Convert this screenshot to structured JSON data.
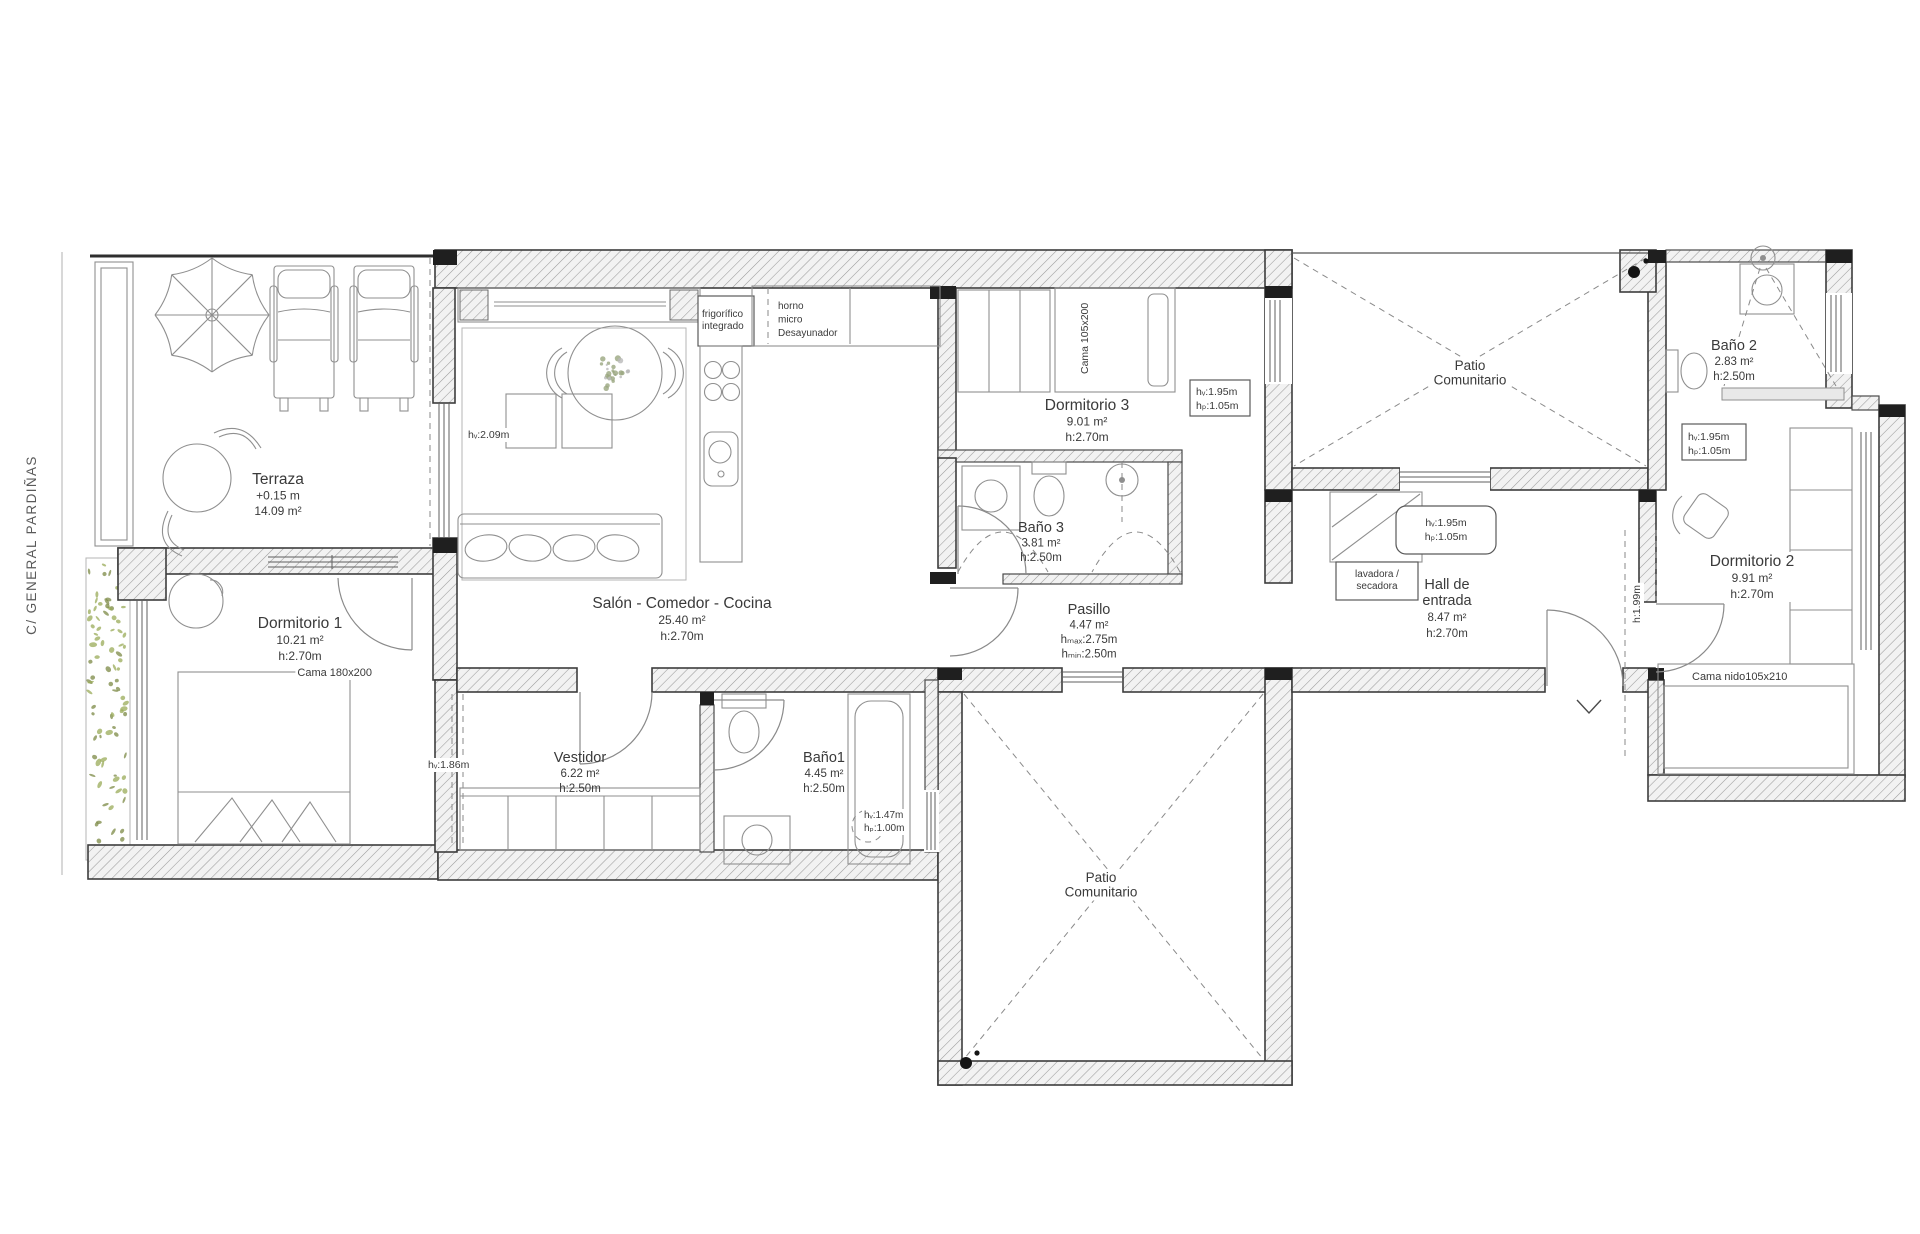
{
  "street": {
    "label": "C/ GENERAL PARDIÑAS"
  },
  "colors": {
    "text": "#3a3a3a",
    "street_text": "#5a5a5a",
    "planter_green": "#9aab58",
    "planter_green_dark": "#7c8a46",
    "flower_gray": "#9aa67f"
  },
  "rooms": {
    "terraza": {
      "name": "Terraza",
      "elevation": "+0.15 m",
      "area": "14.09 m²"
    },
    "dormitorio1": {
      "name": "Dormitorio 1",
      "area": "10.21 m²",
      "height": "h:2.70m",
      "bed": "Cama 180x200"
    },
    "salon": {
      "name": "Salón - Comedor - Cocina",
      "area": "25.40 m²",
      "height": "h:2.70m"
    },
    "dormitorio3": {
      "name": "Dormitorio 3",
      "area": "9.01 m²",
      "height": "h:2.70m",
      "bed": "Cama 105x200"
    },
    "bano3": {
      "name": "Baño 3",
      "area": "3.81 m²",
      "height": "h:2.50m"
    },
    "pasillo": {
      "name": "Pasillo",
      "area": "4.47 m²",
      "height_max": "hₘₐₓ:2.75m",
      "height_min": "hₘᵢₙ:2.50m"
    },
    "patio_top": {
      "name": "Patio Comunitario"
    },
    "hall": {
      "name": "Hall de entrada",
      "area": "8.47 m²",
      "height": "h:2.70m",
      "closet": "lavadora / secadora"
    },
    "bano2": {
      "name": "Baño 2",
      "area": "2.83 m²",
      "height": "h:2.50m"
    },
    "dormitorio2": {
      "name": "Dormitorio 2",
      "area": "9.91 m²",
      "height": "h:2.70m",
      "bed": "Cama nido105x210",
      "door_height": "h:1.99m"
    },
    "vestidor": {
      "name": "Vestidor",
      "area": "6.22 m²",
      "height": "h:2.50m",
      "ceiling_note": "hᵥ:1.86m"
    },
    "bano1": {
      "name": "Baño1",
      "area": "4.45 m²",
      "height": "h:2.50m",
      "window_note": [
        "hᵥ:1.47m",
        "hₚ:1.00m"
      ]
    },
    "patio_bottom": {
      "name": "Patio Comunitario"
    },
    "kitchen_notes": [
      "frigorífico integrado",
      "horno",
      "micro",
      "Desayunador"
    ],
    "window_notes": {
      "salon_terraza": "hᵥ:2.09m",
      "dorm3": [
        "hᵥ:1.95m",
        "hₚ:1.05m"
      ],
      "hall": [
        "hᵥ:1.95m",
        "hₚ:1.05m"
      ],
      "dorm2": [
        "hᵥ:1.95m",
        "hₚ:1.05m"
      ]
    }
  },
  "labels": [
    {
      "id": "street",
      "x": 36,
      "y": 545,
      "rot": -90,
      "fs": 13.5,
      "ls": 1.4,
      "color": "#5a5a5a",
      "lines": [
        "C/ GENERAL PARDIÑAS"
      ]
    },
    {
      "id": "terraza",
      "x": 278,
      "y": 484,
      "fs": 15.5,
      "fs2": 12,
      "lh": 15.5,
      "lines": [
        "Terraza",
        "+0.15 m",
        "14.09 m²"
      ]
    },
    {
      "id": "dormitorio1",
      "x": 300,
      "y": 628,
      "fs": 15.5,
      "fs2": 12,
      "lh": 16,
      "lines": [
        "Dormitorio 1",
        "10.21 m²",
        "h:2.70m"
      ]
    },
    {
      "id": "cama180",
      "x": 372,
      "y": 676,
      "fs": 11,
      "anchor": "end",
      "bg": true,
      "lines": [
        "Cama 180x200"
      ]
    },
    {
      "id": "salon",
      "x": 682,
      "y": 608,
      "fs": 15.5,
      "fs2": 12,
      "lh": 16,
      "lines": [
        "Salón - Comedor - Cocina",
        "25.40 m²",
        "h:2.70m"
      ]
    },
    {
      "id": "frigo",
      "x": 702,
      "y": 317,
      "fs": 10,
      "lh": 12,
      "anchor": "start",
      "lines": [
        "frigorífico",
        "integrado"
      ]
    },
    {
      "id": "horno",
      "x": 778,
      "y": 309,
      "fs": 10,
      "lh": 13.5,
      "anchor": "start",
      "lines": [
        "horno",
        "micro",
        "Desayunador"
      ]
    },
    {
      "id": "hv209",
      "x": 468,
      "y": 438,
      "fs": 10.5,
      "anchor": "start",
      "bg": true,
      "lines": [
        "hᵥ:2.09m"
      ]
    },
    {
      "id": "dormitorio3",
      "x": 1087,
      "y": 410,
      "fs": 15.5,
      "fs2": 12,
      "lh": 15.5,
      "lines": [
        "Dormitorio 3",
        "9.01 m²",
        "h:2.70m"
      ]
    },
    {
      "id": "cama105",
      "x": 1088,
      "y": 374,
      "rot": -90,
      "fs": 10.5,
      "anchor": "start",
      "bg": true,
      "lines": [
        "Cama 105x200"
      ]
    },
    {
      "id": "win_d3",
      "x": 1196,
      "y": 395,
      "fs": 10.5,
      "lh": 14,
      "anchor": "start",
      "lines": [
        "hᵥ:1.95m",
        "hₚ:1.05m"
      ]
    },
    {
      "id": "bano3",
      "x": 1041,
      "y": 532,
      "fs": 14.5,
      "fs2": 11.5,
      "lh": 14.5,
      "lines": [
        "Baño 3",
        "3.81 m²",
        "h:2.50m"
      ]
    },
    {
      "id": "pasillo",
      "x": 1089,
      "y": 614,
      "fs": 14.5,
      "fs2": 11.5,
      "lh": 14.5,
      "lines": [
        "Pasillo",
        "4.47 m²",
        "hₘₐₓ:2.75m",
        "hₘᵢₙ:2.50m"
      ]
    },
    {
      "id": "patio_top",
      "x": 1470,
      "y": 370,
      "fs": 13.5,
      "lh": 14.5,
      "big": 2,
      "bg": true,
      "lines": [
        "Patio",
        "Comunitario"
      ]
    },
    {
      "id": "lavadora",
      "x": 1377,
      "y": 577,
      "fs": 10,
      "lh": 12,
      "lines": [
        "lavadora /",
        "secadora"
      ]
    },
    {
      "id": "win_hall",
      "x": 1446,
      "y": 526,
      "fs": 10.5,
      "lh": 14,
      "lines": [
        "hᵥ:1.95m",
        "hₚ:1.05m"
      ]
    },
    {
      "id": "hall",
      "x": 1447,
      "y": 589,
      "fs": 14.5,
      "fs2": 11.5,
      "lh": 16,
      "big": 2,
      "lines": [
        "Hall de",
        "entrada",
        "8.47 m²",
        "h:2.70m"
      ]
    },
    {
      "id": "bano2",
      "x": 1734,
      "y": 350,
      "fs": 14.5,
      "fs2": 11.5,
      "lh": 15,
      "bg": true,
      "lines": [
        "Baño 2",
        "2.83 m²",
        "h:2.50m"
      ]
    },
    {
      "id": "win_b2",
      "x": 1688,
      "y": 440,
      "fs": 10.5,
      "lh": 14,
      "anchor": "start",
      "lines": [
        "hᵥ:1.95m",
        "hₚ:1.05m"
      ]
    },
    {
      "id": "dormitorio2",
      "x": 1752,
      "y": 566,
      "fs": 15.5,
      "fs2": 12,
      "lh": 16,
      "bg": true,
      "lines": [
        "Dormitorio 2",
        "9.91 m²",
        "h:2.70m"
      ]
    },
    {
      "id": "h199",
      "x": 1640,
      "y": 604,
      "rot": -90,
      "fs": 10.5,
      "bg": true,
      "lines": [
        "h:1.99m"
      ]
    },
    {
      "id": "camanido",
      "x": 1692,
      "y": 680,
      "fs": 11,
      "anchor": "start",
      "bg": true,
      "lines": [
        "Cama nido105x210"
      ]
    },
    {
      "id": "vestidor",
      "x": 580,
      "y": 762,
      "fs": 14.5,
      "fs2": 11.5,
      "lh": 15,
      "lines": [
        "Vestidor",
        "6.22 m²",
        "h:2.50m"
      ]
    },
    {
      "id": "bano1",
      "x": 824,
      "y": 762,
      "fs": 14.5,
      "fs2": 11.5,
      "lh": 15,
      "lines": [
        "Baño1",
        "4.45 m²",
        "h:2.50m"
      ]
    },
    {
      "id": "hv186",
      "x": 428,
      "y": 768,
      "fs": 10.5,
      "anchor": "start",
      "bg": true,
      "lines": [
        "hᵥ:1.86m"
      ]
    },
    {
      "id": "win_b1",
      "x": 864,
      "y": 818,
      "fs": 10,
      "lh": 13,
      "anchor": "start",
      "bg": true,
      "lines": [
        "hᵥ:1.47m",
        "hₚ:1.00m"
      ]
    },
    {
      "id": "patio_bottom",
      "x": 1101,
      "y": 882,
      "fs": 13.5,
      "lh": 14.5,
      "big": 2,
      "bg": true,
      "lines": [
        "Patio",
        "Comunitario"
      ]
    }
  ]
}
